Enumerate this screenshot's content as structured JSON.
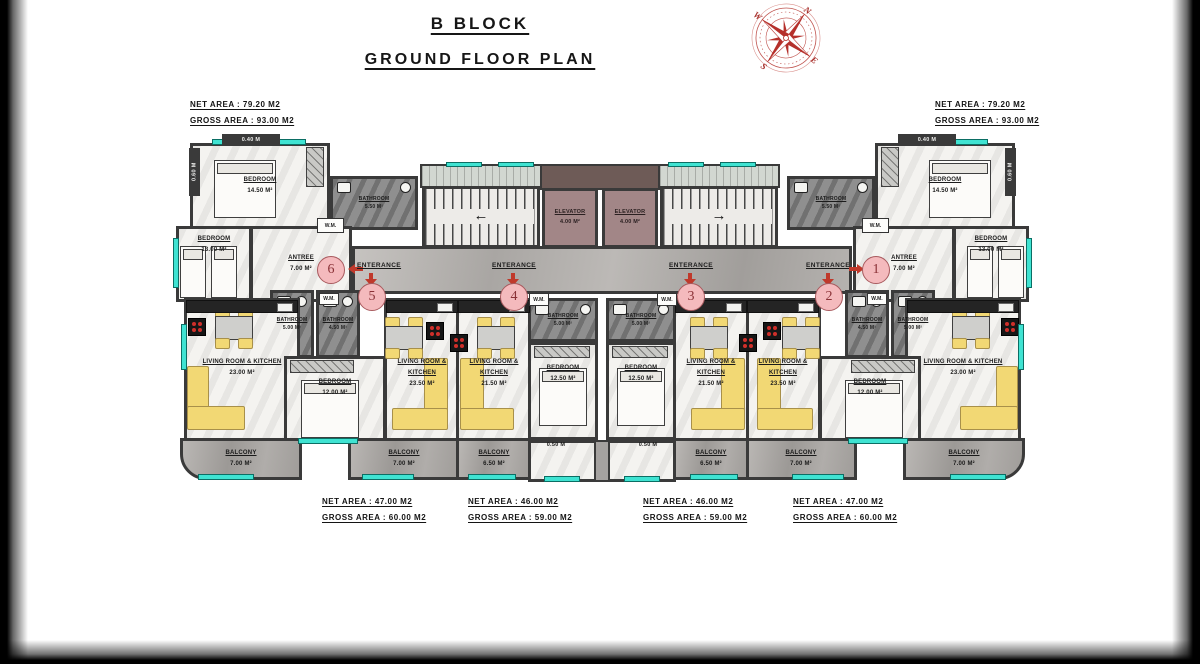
{
  "title": {
    "block": "B BLOCK",
    "floor": "GROUND FLOOR PLAN"
  },
  "compass": {
    "n": "N",
    "e": "E",
    "s": "S",
    "w": "W"
  },
  "summary": {
    "top_left": {
      "net": "NET AREA : 79.20 M2",
      "gross": "GROSS AREA : 93.00 M2"
    },
    "top_right": {
      "net": "NET AREA : 79.20 M2",
      "gross": "GROSS AREA : 93.00 M2"
    },
    "bottom": [
      {
        "net": "NET AREA : 47.00 M2",
        "gross": "GROSS AREA : 60.00 M2"
      },
      {
        "net": "NET AREA : 46.00 M2",
        "gross": "GROSS AREA : 59.00 M2"
      },
      {
        "net": "NET AREA : 46.00 M2",
        "gross": "GROSS AREA : 59.00 M2"
      },
      {
        "net": "NET AREA : 47.00 M2",
        "gross": "GROSS AREA : 60.00 M2"
      }
    ]
  },
  "rooms": {
    "bedroom_1450": {
      "name": "BEDROOM",
      "area": "14.50 M²"
    },
    "bathroom_550": {
      "name": "BATHROOM",
      "area": "5.50 M²"
    },
    "bedroom_1300": {
      "name": "BEDROOM",
      "area": "13.00 M²"
    },
    "antree_700": {
      "name": "ANTREE",
      "area": "7.00 M²"
    },
    "living_2300": {
      "name": "LIVING ROOM & KITCHEN",
      "area": "23.00 M²"
    },
    "living_2350": {
      "name": "LIVING ROOM & KITCHEN",
      "area": "23.50 M²"
    },
    "living_2150": {
      "name": "LIVING ROOM & KITCHEN",
      "area": "21.50 M²"
    },
    "bedroom_1200": {
      "name": "BEDROOM",
      "area": "12.00 M²"
    },
    "bedroom_1250": {
      "name": "BEDROOM",
      "area": "12.50 M²"
    },
    "bathroom_500": {
      "name": "BATHROOM",
      "area": "5.00 M²"
    },
    "bathroom_450": {
      "name": "BATHROOM",
      "area": "4.50 M²"
    },
    "balcony_700": {
      "name": "BALCONY",
      "area": "7.00 M²"
    },
    "balcony_650": {
      "name": "BALCONY",
      "area": "6.50 M²"
    }
  },
  "elevator": {
    "name": "ELEVATOR",
    "area": "4.00 M²"
  },
  "entrance": {
    "label": "ENTERANCE",
    "numbers": {
      "n1": "1",
      "n2": "2",
      "n3": "3",
      "n4": "4",
      "n5": "5",
      "n6": "6"
    }
  },
  "labels": {
    "wm": "W.M."
  },
  "dimensions": {
    "d040": "0.40 M",
    "d050": "0.50 M",
    "d060": "0.60 M"
  },
  "stairs": {
    "left_arrow": "←",
    "right_arrow": "→"
  },
  "colors": {
    "teal": "#3fe3d2",
    "sofa_yellow": "#f2d874",
    "wall": "#3a3a3a",
    "entrance_red": "#c0392b",
    "badge_pink": "#f4babd",
    "elevator_mauve": "#a28687"
  }
}
